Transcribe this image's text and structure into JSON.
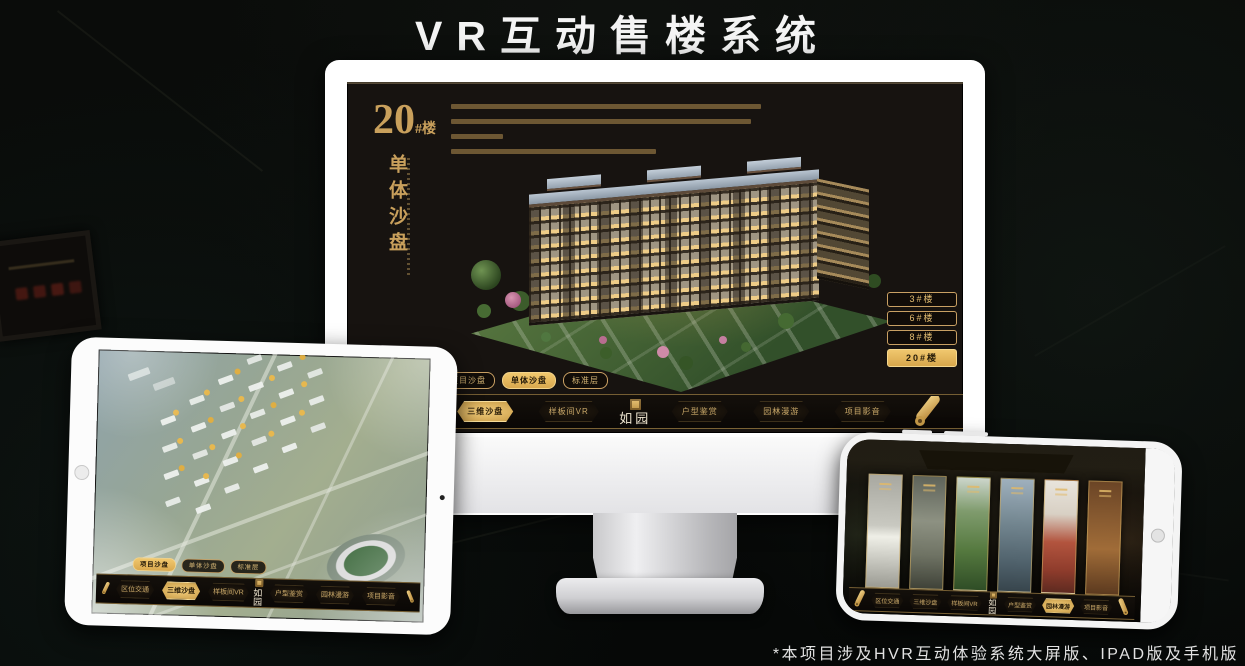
{
  "page": {
    "title": "VR互动售楼系统",
    "footnote": "*本项目涉及HVR互动体验系统大屏版、IPAD版及手机版"
  },
  "colors": {
    "accent_gold": "#d0a65c",
    "active_button_bg": "#e0b35c",
    "screen_bg": "#171310",
    "title_text": "#f4f4f4"
  },
  "icons": {
    "scroll": "scroll-menu-icon",
    "seal": "seal-stamp-icon"
  },
  "monitor": {
    "block": {
      "number": "20",
      "suffix": "#楼",
      "subtitle": "单体沙盘"
    },
    "floor_buttons": [
      {
        "label": "3#楼",
        "active": false
      },
      {
        "label": "6#楼",
        "active": false
      },
      {
        "label": "8#楼",
        "active": false
      },
      {
        "label": "20#楼",
        "active": true
      }
    ],
    "mode_tabs": [
      {
        "label": "项目沙盘",
        "active": false
      },
      {
        "label": "单体沙盘",
        "active": true
      },
      {
        "label": "标准层",
        "active": false
      }
    ],
    "nav": {
      "logo": "如园",
      "items": [
        {
          "label": "区位交通",
          "active": false
        },
        {
          "label": "三维沙盘",
          "active": true
        },
        {
          "label": "样板间VR",
          "active": false
        },
        {
          "label": "户型鉴赏",
          "active": false
        },
        {
          "label": "园林漫游",
          "active": false
        },
        {
          "label": "项目影音",
          "active": false
        }
      ]
    }
  },
  "ipad": {
    "mode_tabs": [
      {
        "label": "项目沙盘",
        "active": true
      },
      {
        "label": "单体沙盘",
        "active": false
      },
      {
        "label": "标准层",
        "active": false
      }
    ],
    "nav": {
      "logo": "如园",
      "items": [
        {
          "label": "区位交通",
          "active": false
        },
        {
          "label": "三维沙盘",
          "active": true
        },
        {
          "label": "样板间VR",
          "active": false
        },
        {
          "label": "户型鉴赏",
          "active": false
        },
        {
          "label": "园林漫游",
          "active": false
        },
        {
          "label": "项目影音",
          "active": false
        }
      ]
    }
  },
  "phone": {
    "nav": {
      "logo": "如园",
      "items": [
        {
          "label": "区位交通",
          "active": false
        },
        {
          "label": "三维沙盘",
          "active": false
        },
        {
          "label": "样板间VR",
          "active": false
        },
        {
          "label": "户型鉴赏",
          "active": false
        },
        {
          "label": "园林漫游",
          "active": true
        },
        {
          "label": "项目影音",
          "active": false
        }
      ]
    }
  }
}
